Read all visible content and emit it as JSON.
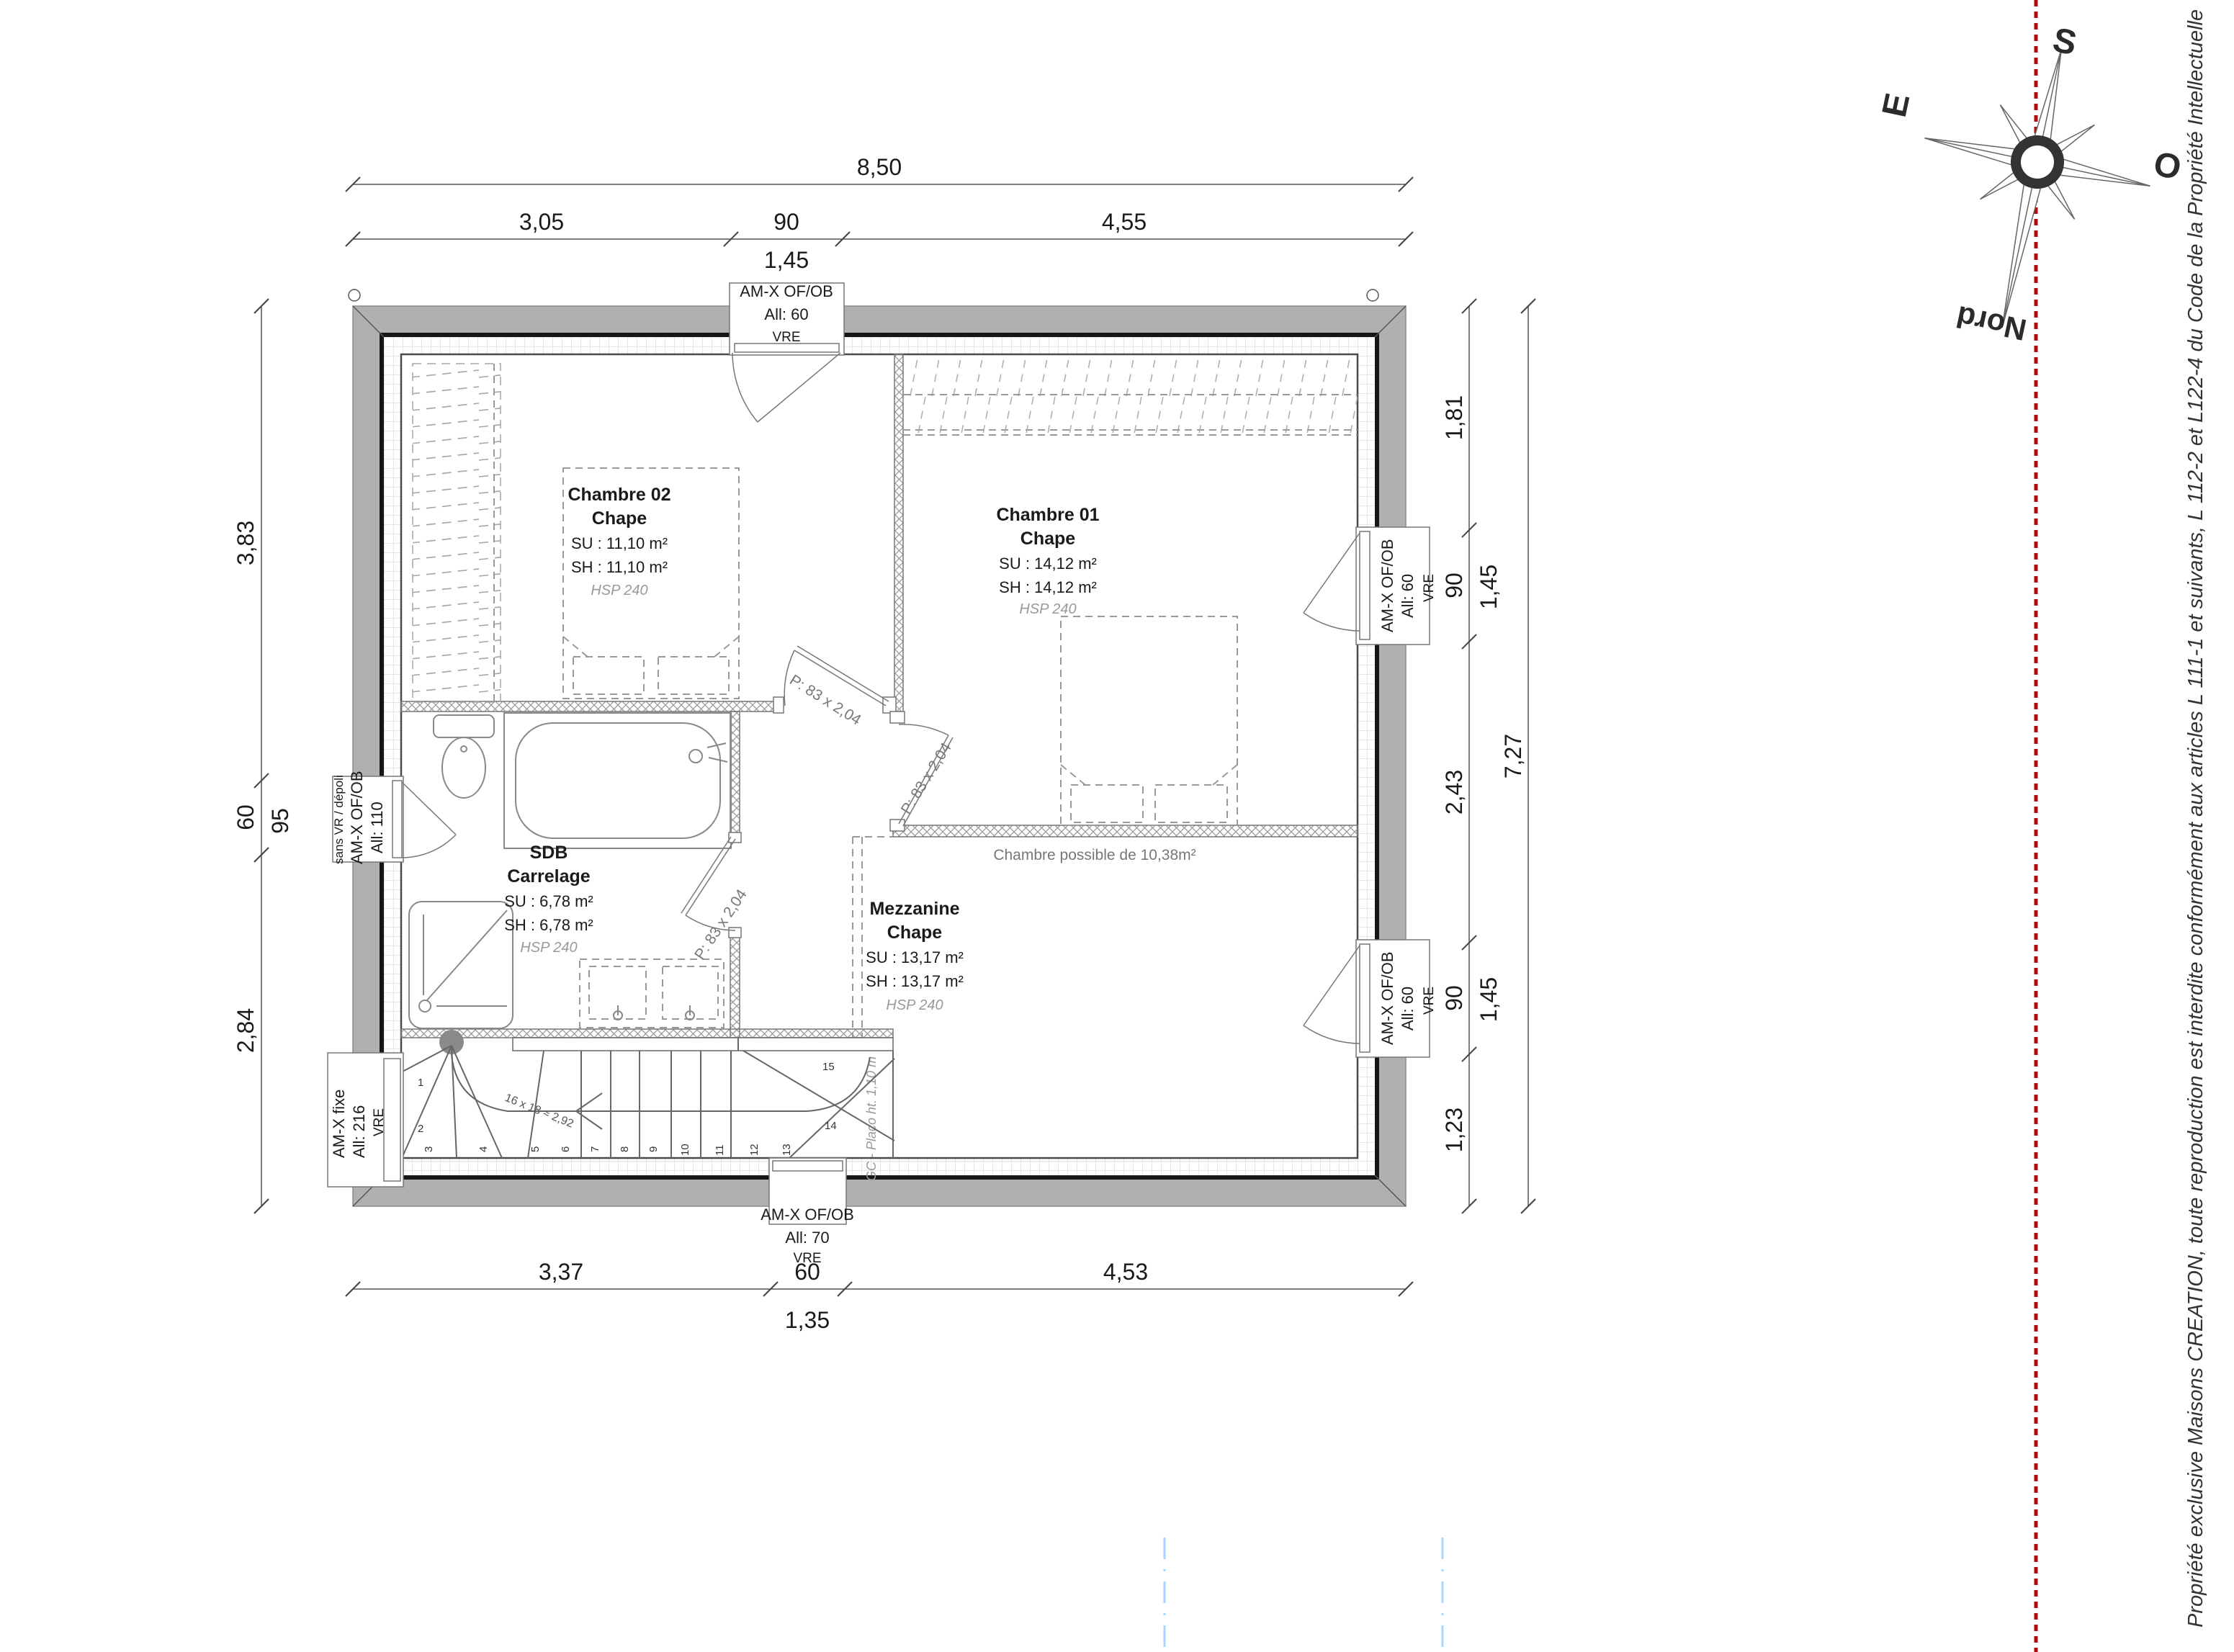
{
  "dimensions": {
    "top": {
      "overall": "8,50",
      "segments": [
        "3,05",
        "90",
        "4,55"
      ],
      "nested": "1,45"
    },
    "left": {
      "segments": [
        "3,83",
        "60",
        "2,84"
      ],
      "nested": "95"
    },
    "right": {
      "segments": [
        "1,81",
        "90",
        "2,43",
        "90",
        "1,23"
      ],
      "nested": [
        "1,45",
        "1,45"
      ],
      "overall": "7,27"
    },
    "bottom": {
      "segments": [
        "3,37",
        "60",
        "4,53"
      ],
      "nested": "1,35"
    }
  },
  "rooms": {
    "ch02": {
      "name": "Chambre 02",
      "floor": "Chape",
      "su": "SU : 11,10 m²",
      "sh": "SH : 11,10 m²",
      "hsp": "HSP 240"
    },
    "ch01": {
      "name": "Chambre 01",
      "floor": "Chape",
      "su": "SU : 14,12 m²",
      "sh": "SH : 14,12 m²",
      "hsp": "HSP 240"
    },
    "sdb": {
      "name": "SDB",
      "floor": "Carrelage",
      "su": "SU : 6,78 m²",
      "sh": "SH : 6,78 m²",
      "hsp": "HSP 240"
    },
    "mezzanine": {
      "name": "Mezzanine",
      "floor": "Chape",
      "su": "SU : 13,17 m²",
      "sh": "SH : 13,17 m²",
      "hsp": "HSP 240"
    }
  },
  "windows": {
    "top": {
      "l1": "AM-X OF/OB",
      "l2": "All:  60",
      "l3": "VRE"
    },
    "left": {
      "l0": "sans VR / dépoli",
      "l1": "AM-X OF/OB",
      "l2": "All:  110"
    },
    "fixed": {
      "l1": "AM-X fixe",
      "l2": "All:  216",
      "l3": "VRE"
    },
    "right1": {
      "l1": "AM-X OF/OB",
      "l2": "All:  60",
      "l3": "VRE"
    },
    "right2": {
      "l1": "AM-X OF/OB",
      "l2": "All:  60",
      "l3": "VRE"
    },
    "bottom": {
      "l1": "AM-X OF/OB",
      "l2": "All:  70",
      "l3": "VRE"
    }
  },
  "doors": {
    "d1": "P: 83 x 2,04",
    "d2": "P: 83 x 2,04",
    "d3": "P: 83 x 2,04"
  },
  "stairs": {
    "numbers": [
      "1",
      "2",
      "3",
      "4",
      "5",
      "6",
      "7",
      "8",
      "9",
      "10",
      "11",
      "12",
      "13",
      "14",
      "15"
    ],
    "formula": "16 x 18 ≈ 2,92",
    "guard_note": "GC - Placo ht. 1,10 m"
  },
  "notes": {
    "chambre_possible": "Chambre possible de 10,38m²"
  },
  "compass": {
    "north": "Nord",
    "south": "S",
    "east": "E",
    "west": "O"
  },
  "copyright": "Propriété exclusive Maisons CREATION, toute reproduction est interdite conformément aux articles L 111-1 et suivants, L 112-2 et L122-4 du Code de la Propriété Intellectuelle"
}
